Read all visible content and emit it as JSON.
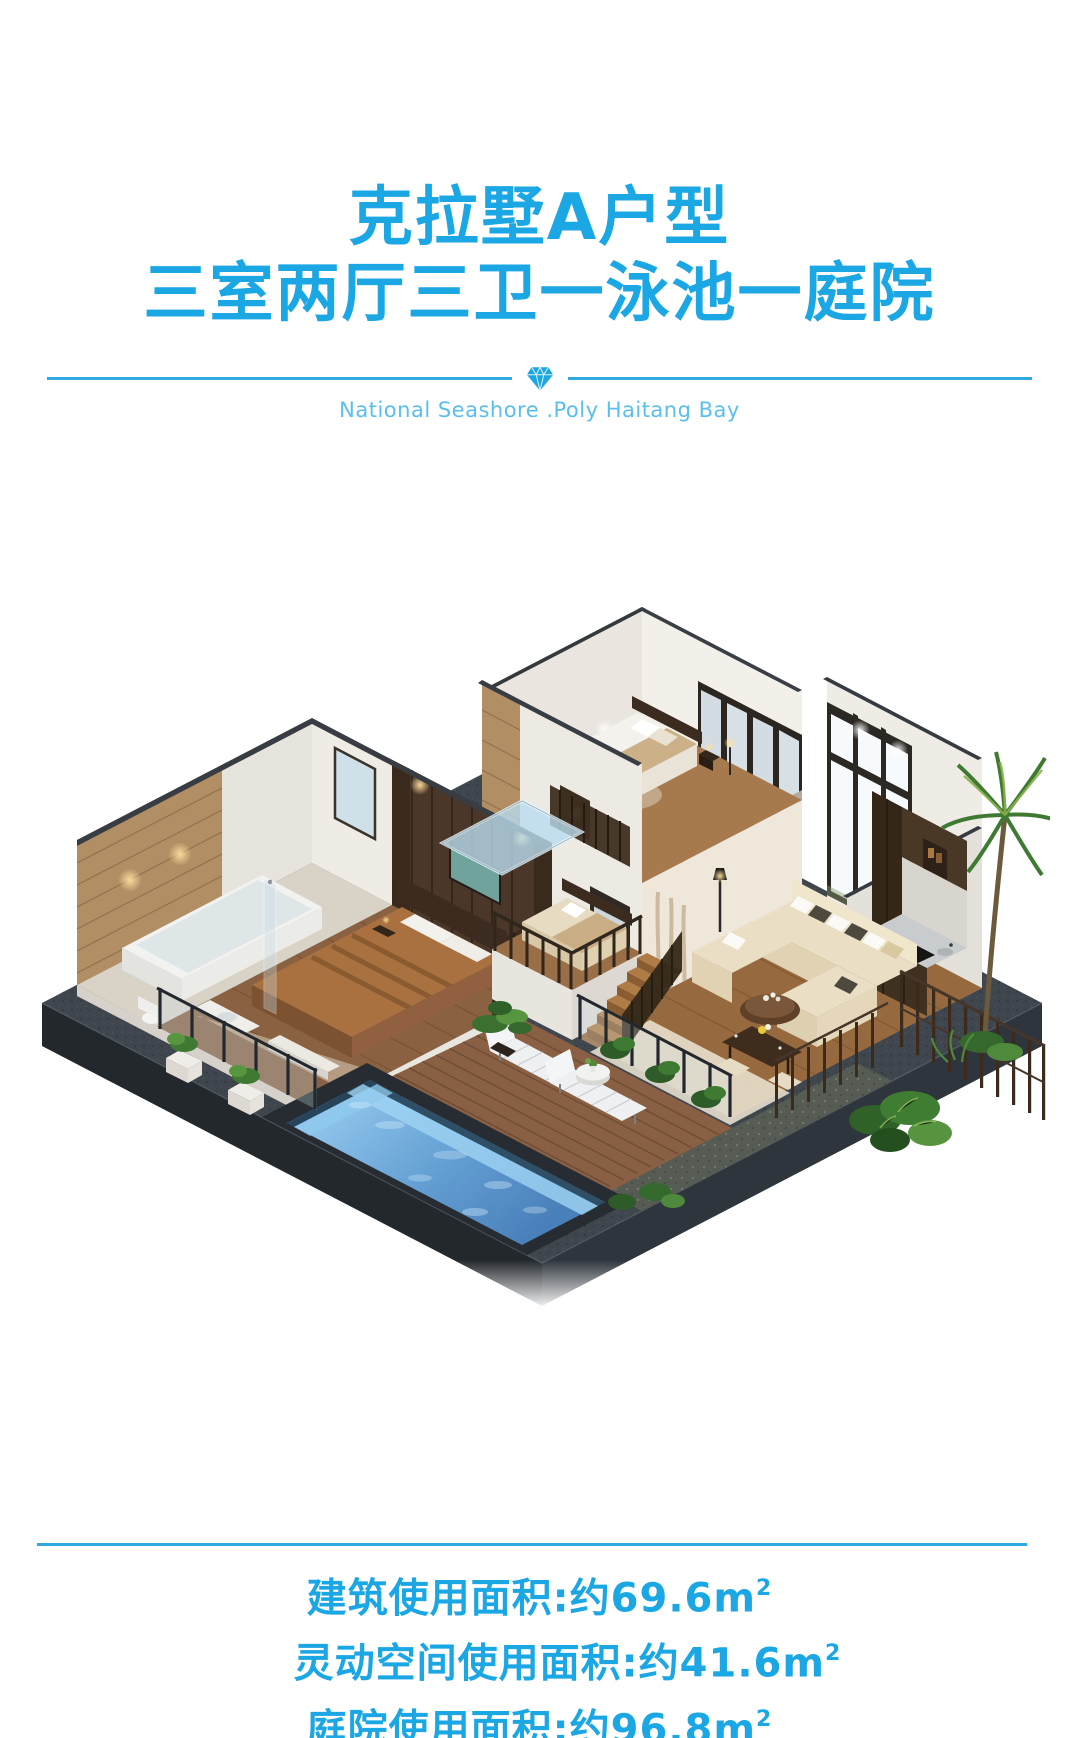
{
  "page": {
    "background": "#ffffff",
    "accent": "#1ba6e4",
    "accent_light": "#5abfea",
    "divider_color": "#2fa9df"
  },
  "header": {
    "title_line1": "克拉墅A户型",
    "title_line2": "三室两厅三卫一泳池一庭院",
    "tagline_en": "National Seashore .Poly Haitang Bay",
    "divider_icon": "diamond-icon"
  },
  "villa_illustration": {
    "type": "isometric-3d-cutaway-floorplan",
    "features": [
      "dark-stone-plinth",
      "swimming-pool",
      "wood-deck",
      "two-sun-loungers",
      "side-table",
      "master-bedroom",
      "bathroom-with-tub",
      "living-room-curved-sofa",
      "kitchen",
      "dining-set",
      "stairs",
      "upper-floor-bedroom",
      "glass-canopy",
      "garden-plants",
      "palm-tree",
      "slat-fence",
      "stone-accent-walls"
    ],
    "colors": {
      "plinth_top": "#3f464d",
      "plinth_side_dark": "#23282d",
      "plinth_side_light": "#2f353c",
      "pool_water": "#5f9bd0",
      "pool_glow": "#9fd4f2",
      "deck_wood": "#8a6044",
      "wall_white": "#efece6",
      "stone_wall": "#b18e63",
      "dark_wood": "#4a372a",
      "sofa_cream": "#eadfc4",
      "bed_brown": "#a9713f",
      "foliage": "#3f7a33",
      "window_frame": "#2c2824"
    }
  },
  "footer": {
    "areas": [
      {
        "name": "building-usable-area",
        "text": "建筑使用面积:约69.6",
        "unit_base": "m",
        "unit_sup": "2"
      },
      {
        "name": "flex-space-usable-area",
        "text": "灵动空间使用面积:约41.6",
        "unit_base": "m",
        "unit_sup": "2"
      },
      {
        "name": "courtyard-usable-area",
        "text": "庭院使用面积:约96.8",
        "unit_base": "m",
        "unit_sup": "2"
      }
    ]
  }
}
